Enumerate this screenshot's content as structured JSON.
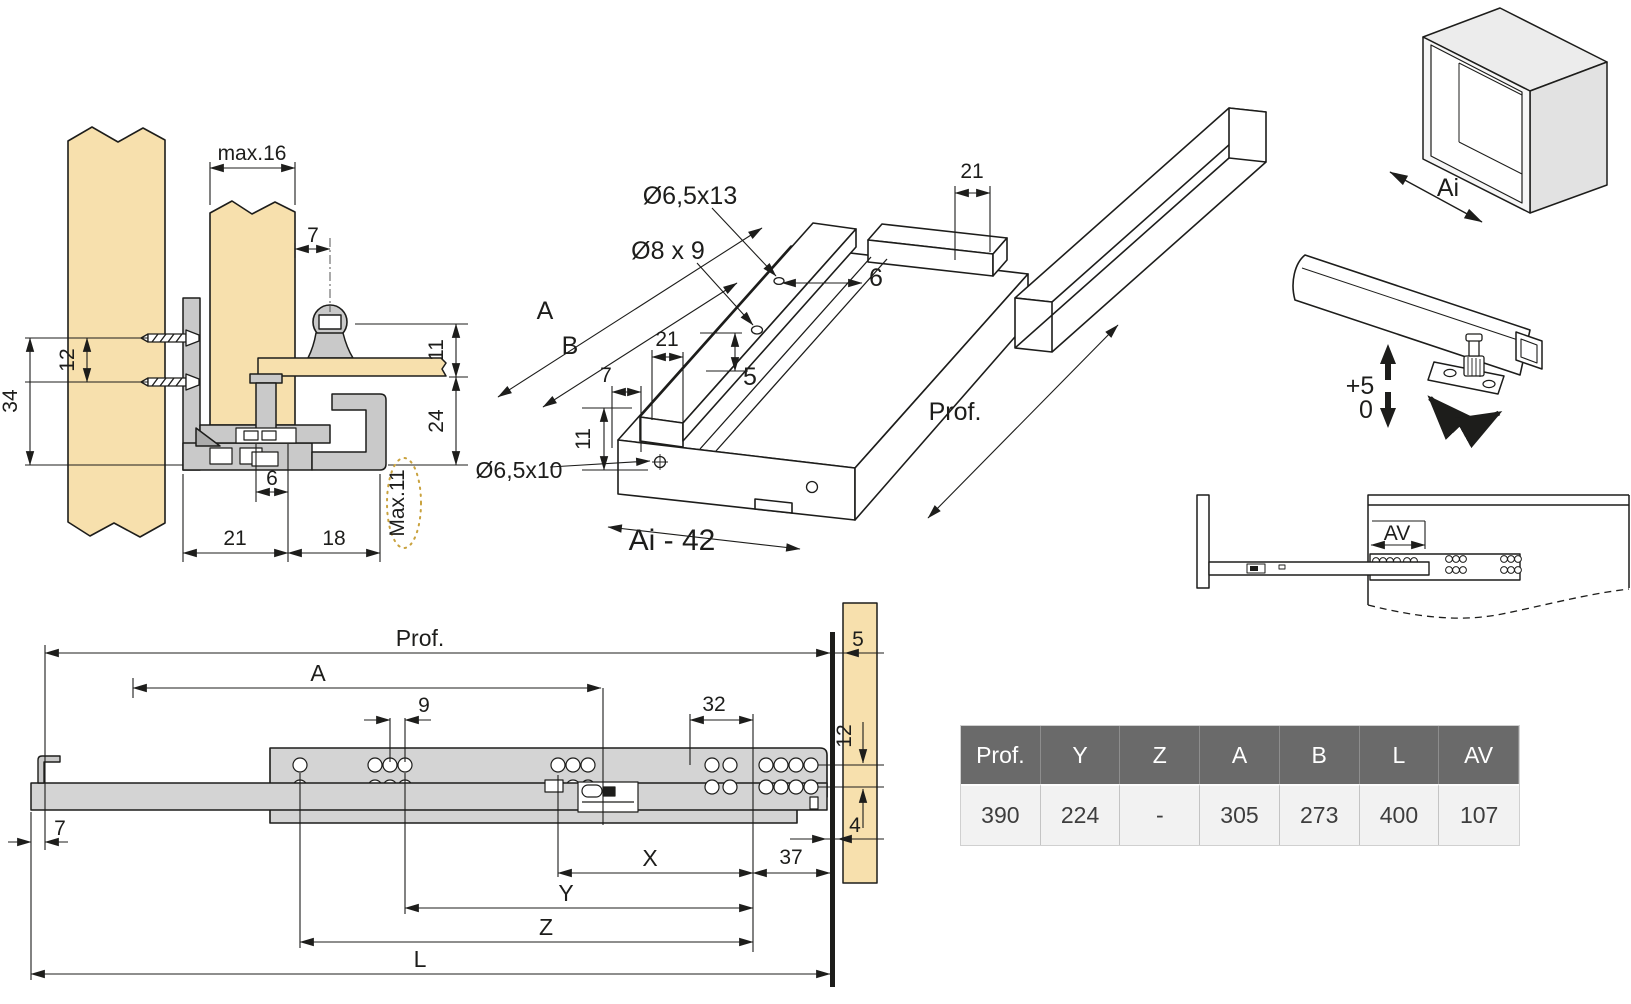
{
  "colors": {
    "wood": "#f7e0ad",
    "metal": "#c9c9c9",
    "metal_light": "#d6d6d6",
    "line": "#1d1d1b",
    "accent_dashed": "#c9a23e",
    "table_header_bg": "#6a6a6a",
    "table_header_text": "#ffffff",
    "table_row_bg": "#f2f2f2",
    "table_row_text": "#3d3d3d"
  },
  "cross_section": {
    "max16": "max.16",
    "d7": "7",
    "d12": "12",
    "d34": "34",
    "d11": "11",
    "d24": "24",
    "d6": "6",
    "d21": "21",
    "d18": "18",
    "max11": "Max.11"
  },
  "isometric": {
    "d21_top": "21",
    "hole_top": "Ø6,5x13",
    "hole_mid": "Ø8 x 9",
    "d6": "6",
    "A": "A",
    "B": "B",
    "d21": "21",
    "d7": "7",
    "d5": "5",
    "d11": "11",
    "hole_front": "Ø6,5x10",
    "prof": "Prof.",
    "ai42": "Ai - 42"
  },
  "cabinet": {
    "ai": "Ai"
  },
  "adjustment": {
    "plus5": "+5",
    "zero": "0"
  },
  "mounted": {
    "av": "AV"
  },
  "side_view": {
    "prof": "Prof.",
    "A": "A",
    "d9": "9",
    "d32": "32",
    "d5": "5",
    "d12": "12",
    "d7": "7",
    "d4": "4",
    "X": "X",
    "d37": "37",
    "Y": "Y",
    "Z": "Z",
    "L": "L"
  },
  "table": {
    "headers": [
      "Prof.",
      "Y",
      "Z",
      "A",
      "B",
      "L",
      "AV"
    ],
    "row": [
      "390",
      "224",
      "-",
      "305",
      "273",
      "400",
      "107"
    ]
  }
}
